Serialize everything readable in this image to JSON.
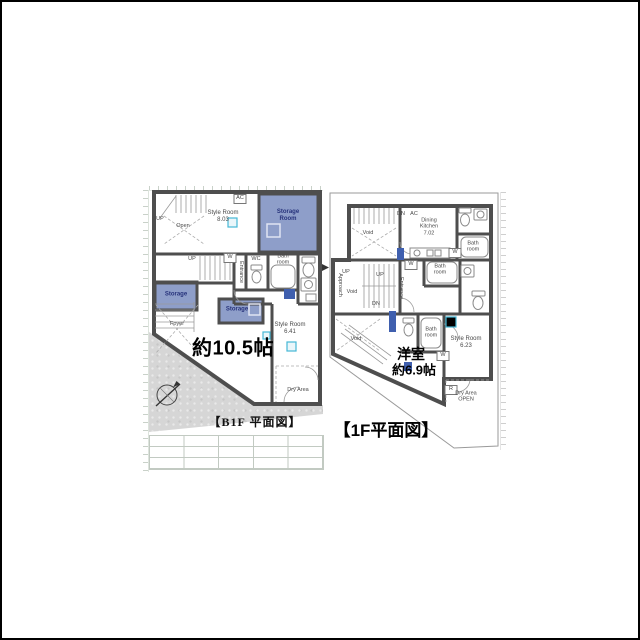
{
  "colors": {
    "wall": "#4e4e4e",
    "storage_fill": "#8e9ec9",
    "accent_blue": "#3f5fae",
    "accent_cyan": "#45b8d6",
    "ground_texture": "#d6d6d6"
  },
  "b1f": {
    "caption": "【B1F 平面図】",
    "labels": {
      "up_top": "UP",
      "open": "Open",
      "style_room_1": "Style Room\n8.03",
      "ac": "AC",
      "storage_room": "Storage\nRoom",
      "up_mid": "UP",
      "w_box": "W",
      "wc": "WC",
      "bath": "Bath\nroom",
      "entrance": "Entrance",
      "storage_left": "Storage",
      "storage_center": "Storage",
      "area_big": "約10.5帖",
      "style_room_2": "Style Room\n6.41",
      "dry_area": "Dry Area",
      "foyer": "Foyer"
    }
  },
  "f1": {
    "caption": "【1F平面図】",
    "labels": {
      "void_top": "Void",
      "dn_top": "DN",
      "ac_top": "AC",
      "dining_kitchen": "Dining\nKitchen\n7.02",
      "w_kitchen": "W",
      "bath_top": "Bath\nroom",
      "up_left": "UP",
      "void_mid": "Void",
      "up_mid": "UP",
      "dn_mid": "DN",
      "entrance": "Entrance",
      "w_mid": "W",
      "bath_mid": "Bath\nroom",
      "void_low": "Void",
      "room_jp": "洋室",
      "room_size_jp": "約6.9帖",
      "bath_low": "Bath\nroom",
      "w_low": "W",
      "r_box": "R",
      "style_room": "Style Room\n6.23",
      "dry_area": "Dry Area\nOPEN",
      "approach": "Approach"
    }
  }
}
